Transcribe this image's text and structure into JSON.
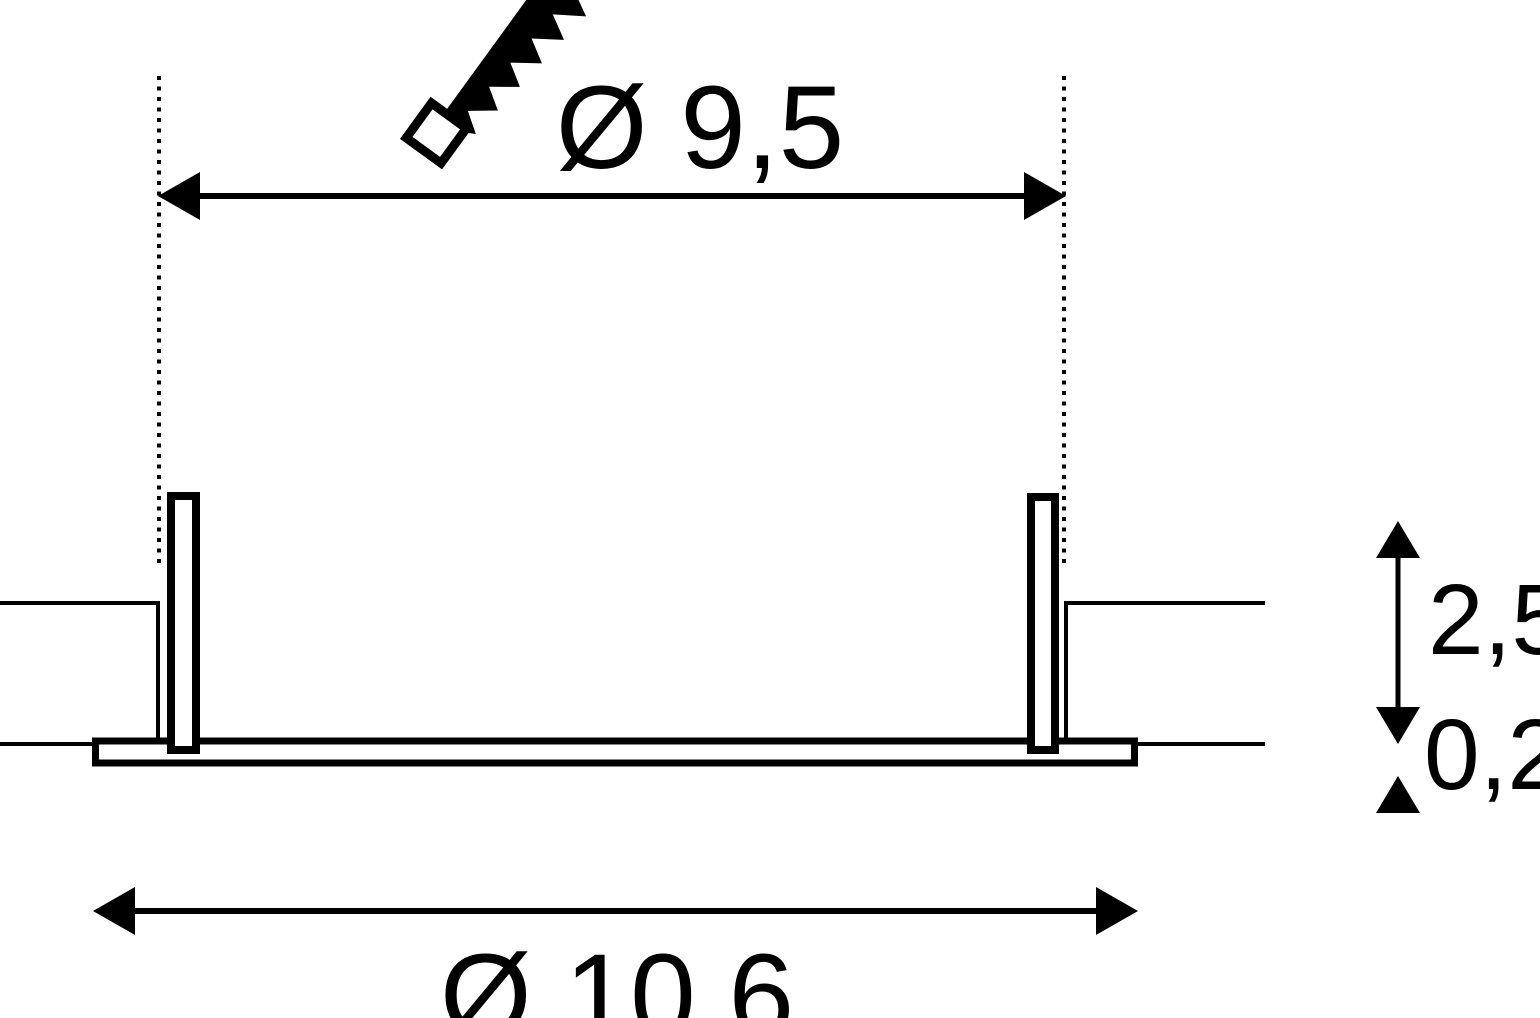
{
  "drawing": {
    "background": "#ffffff",
    "ink": "#000000",
    "icons": [
      "saw-icon"
    ],
    "dimensions": {
      "cutout_diameter": {
        "label": "Ø 9,5"
      },
      "outer_diameter": {
        "label": "Ø 10,6"
      },
      "recess_height": {
        "label": "2,5"
      },
      "flange_thickness": {
        "label": "0,2"
      }
    }
  }
}
